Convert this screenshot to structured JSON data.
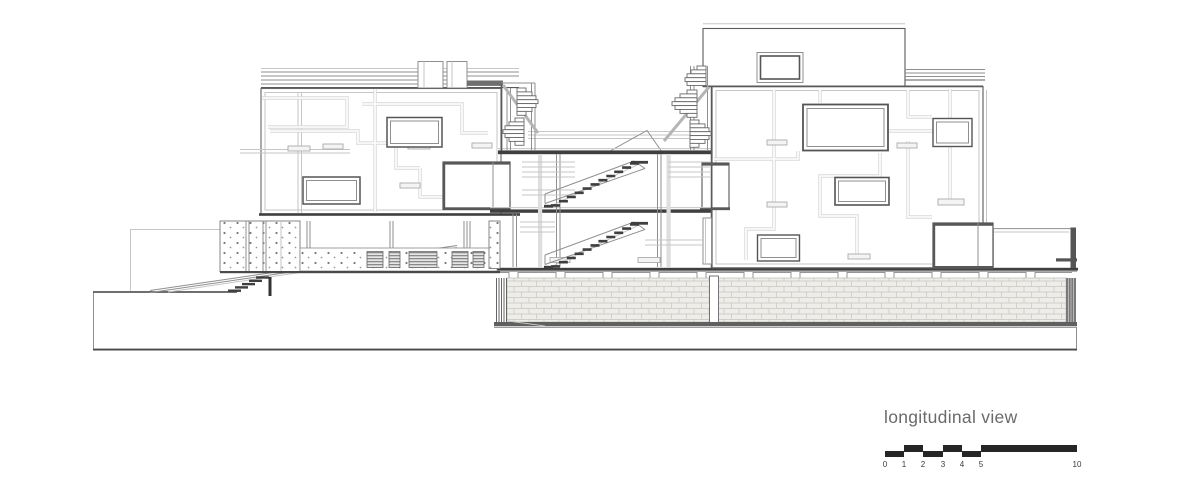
{
  "page": {
    "title": "longitudinal view"
  },
  "drawing": {
    "label": "longitudinal view",
    "kind": "architectural longitudinal section",
    "colors": {
      "background": "#ffffff",
      "ink": "#5a5a5a",
      "ink_dark": "#3f3f3f",
      "ink_mid": "#8f8f8f",
      "ink_light": "#c6c6c6",
      "pipe": "#d8d8d8",
      "slab": "#3f3f3f",
      "brick_fill": "#efedea",
      "brick_line": "#c9c5c0",
      "label_text": "#6a6a6a",
      "scalebar_ink": "#262626"
    }
  },
  "scale": {
    "ticks": [
      "0",
      "1",
      "2",
      "3",
      "4",
      "5",
      "10"
    ]
  }
}
